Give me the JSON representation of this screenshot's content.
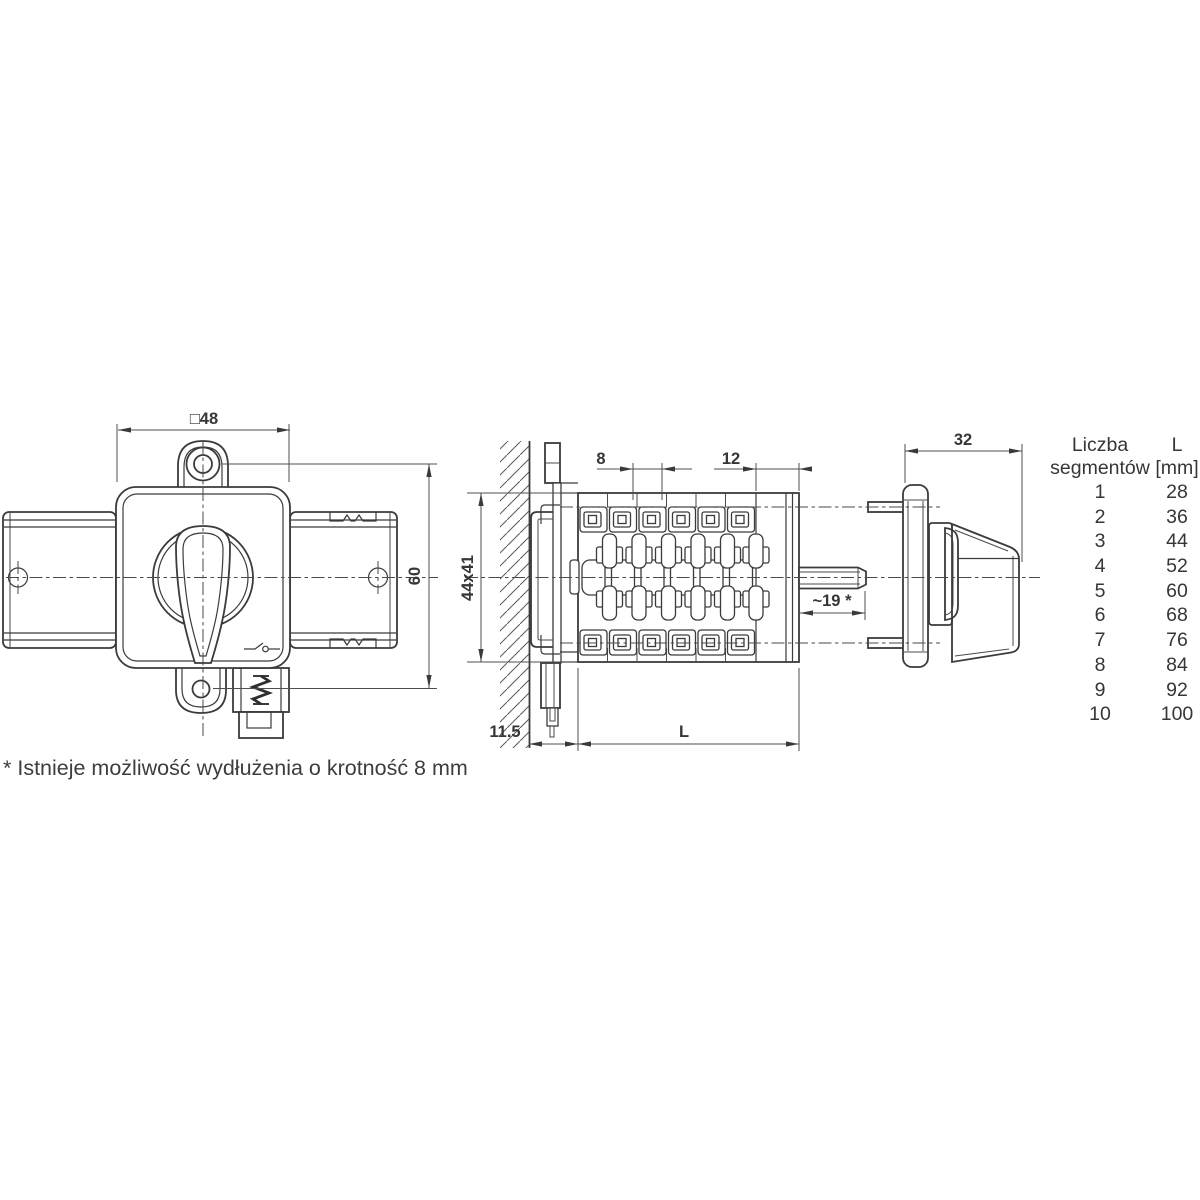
{
  "drawing": {
    "front_view": {
      "dim_width": "□48",
      "dim_height": "60"
    },
    "side_view": {
      "dim_segment_pitch": "8",
      "dim_front_section": "12",
      "dim_body": "44x41",
      "dim_panel_offset": "11.5",
      "dim_length": "L",
      "dim_shaft": "~19 *"
    },
    "profile_view": {
      "dim_depth": "32"
    }
  },
  "table": {
    "header": {
      "col1_line1": "Liczba",
      "col1_line2": "segmentów",
      "col2_line1": "L",
      "col2_line2": "[mm]"
    },
    "rows": [
      {
        "segments": "1",
        "length": "28"
      },
      {
        "segments": "2",
        "length": "36"
      },
      {
        "segments": "3",
        "length": "44"
      },
      {
        "segments": "4",
        "length": "52"
      },
      {
        "segments": "5",
        "length": "60"
      },
      {
        "segments": "6",
        "length": "68"
      },
      {
        "segments": "7",
        "length": "76"
      },
      {
        "segments": "8",
        "length": "84"
      },
      {
        "segments": "9",
        "length": "92"
      },
      {
        "segments": "10",
        "length": "100"
      }
    ]
  },
  "footnote": "* Istnieje możliwość wydłużenia o krotność 8 mm",
  "colors": {
    "line": "#3b3b3b",
    "dim_line": "#4f4f4f",
    "text": "#363636"
  }
}
